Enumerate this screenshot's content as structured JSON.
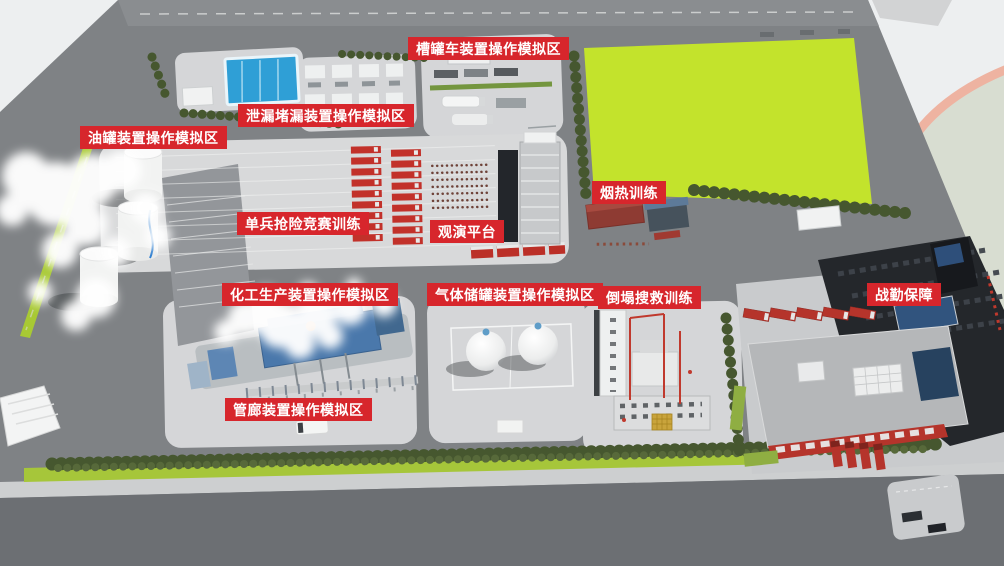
{
  "page": {
    "type": "training-facility-site-map"
  },
  "labels": [
    {
      "id": "tank-truck-zone",
      "text": "槽罐车装置操作模拟区"
    },
    {
      "id": "leak-plugging-zone",
      "text": "泄漏堵漏装置操作模拟区"
    },
    {
      "id": "oil-tank-zone",
      "text": "油罐装置操作模拟区"
    },
    {
      "id": "individual-rescue-training",
      "text": "单兵抢险竞赛训练"
    },
    {
      "id": "viewing-platform",
      "text": "观演平台"
    },
    {
      "id": "smoke-heat-training",
      "text": "烟热训练"
    },
    {
      "id": "chemical-production-zone",
      "text": "化工生产装置操作模拟区"
    },
    {
      "id": "gas-storage-zone",
      "text": "气体储罐装置操作模拟区"
    },
    {
      "id": "collapse-rescue-training",
      "text": "倒塌搜救训练"
    },
    {
      "id": "combat-support",
      "text": "战勤保障"
    },
    {
      "id": "pipe-gallery-zone",
      "text": "管廊装置操作模拟区"
    }
  ],
  "colors": {
    "badge_red": "#d7262c",
    "field_green": "#c3e32c",
    "ground_gray": "#7f8285",
    "pad_gray": "#d5d6d8",
    "road_dark": "#6c6f73",
    "pool_blue": "#2f9fd6",
    "fire_truck_red": "#c2312a",
    "tree_green": "#46572f",
    "track_salmon": "#eeb3a1"
  }
}
